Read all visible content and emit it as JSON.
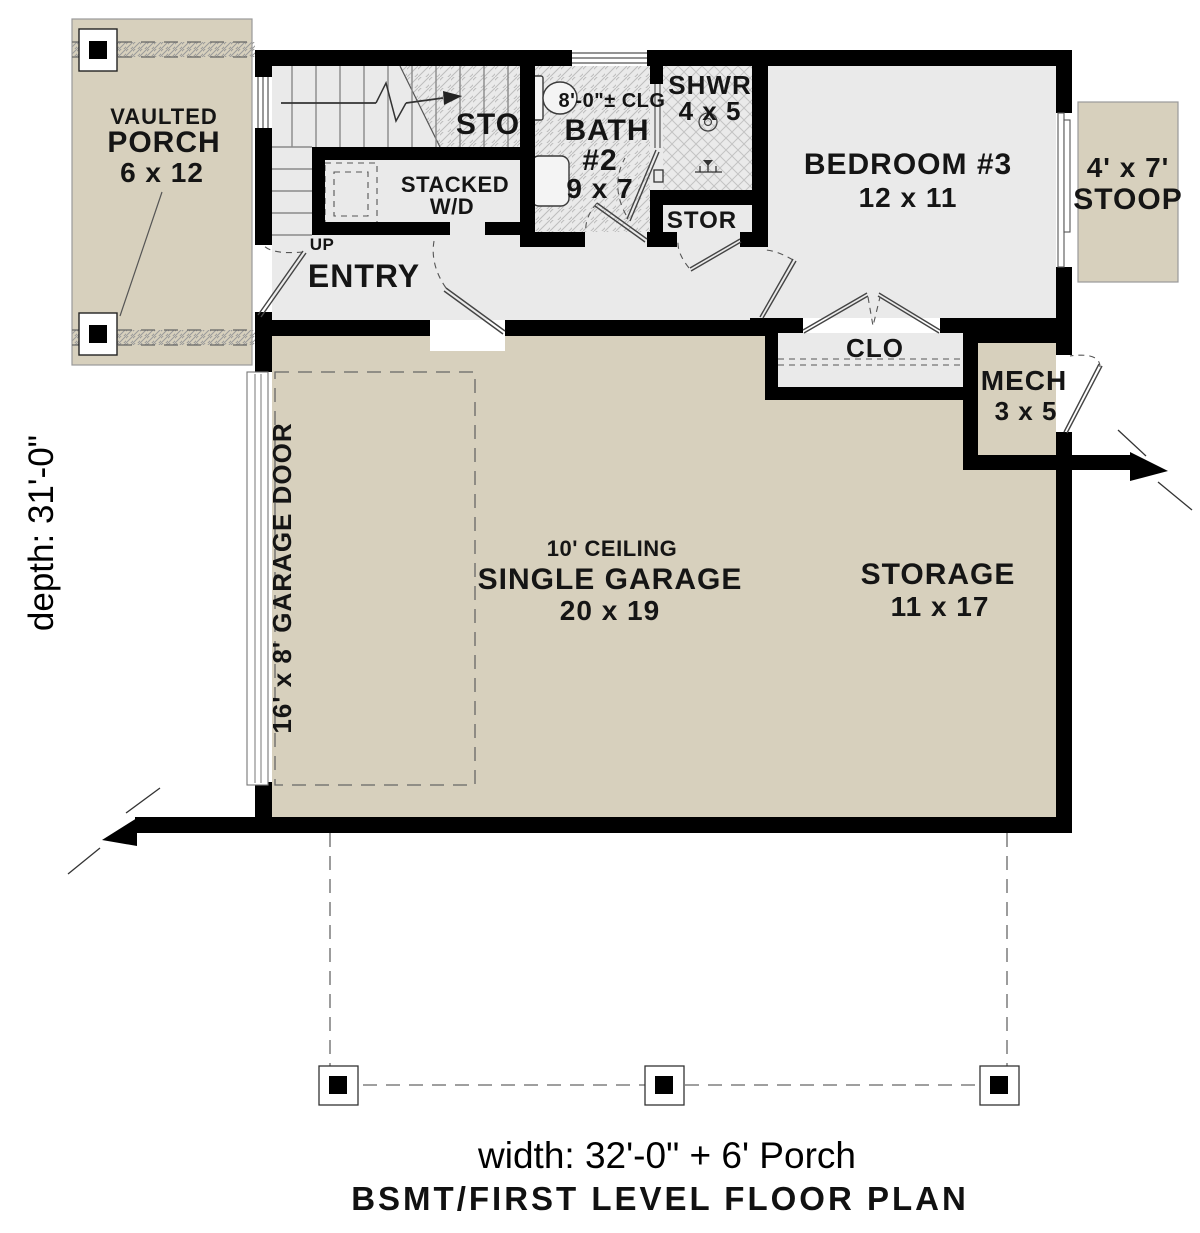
{
  "plan": {
    "rooms": {
      "porch": {
        "line1": "VAULTED",
        "line2": "PORCH",
        "dim": "6 x 12"
      },
      "stairs": {
        "label": "STO",
        "up": "UP"
      },
      "laundry": {
        "line1": "STACKED",
        "line2": "W/D"
      },
      "bath": {
        "ceiling": "8'-0\"± CLG",
        "line1": "BATH",
        "line2": "#2",
        "dim": "9 x 7"
      },
      "shower": {
        "line1": "SHWR",
        "dim": "4 x 5"
      },
      "stor": {
        "label": "STOR"
      },
      "bedroom": {
        "line1": "BEDROOM #3",
        "dim": "12 x 11"
      },
      "stoop": {
        "dim": "4' x 7'",
        "line2": "STOOP"
      },
      "entry": {
        "label": "ENTRY"
      },
      "closet": {
        "label": "CLO"
      },
      "mech": {
        "line1": "MECH",
        "dim": "3 x 5"
      },
      "garage": {
        "ceiling": "10' CEILING",
        "line1": "SINGLE GARAGE",
        "dim": "20 x 19"
      },
      "storage": {
        "line1": "STORAGE",
        "dim": "11 x 17"
      },
      "garage_door": {
        "label": "16' x 8' GARAGE DOOR"
      }
    },
    "dimensions": {
      "depth": "depth: 31'-0\"",
      "width": "width: 32'-0\" + 6' Porch"
    },
    "title": "BSMT/FIRST LEVEL FLOOR PLAN",
    "colors": {
      "wall": "#000000",
      "interior_floor": "#eaeaea",
      "exterior_floor": "#d7d0bd",
      "hatch": "#b9b9b9",
      "line": "#555555"
    }
  }
}
